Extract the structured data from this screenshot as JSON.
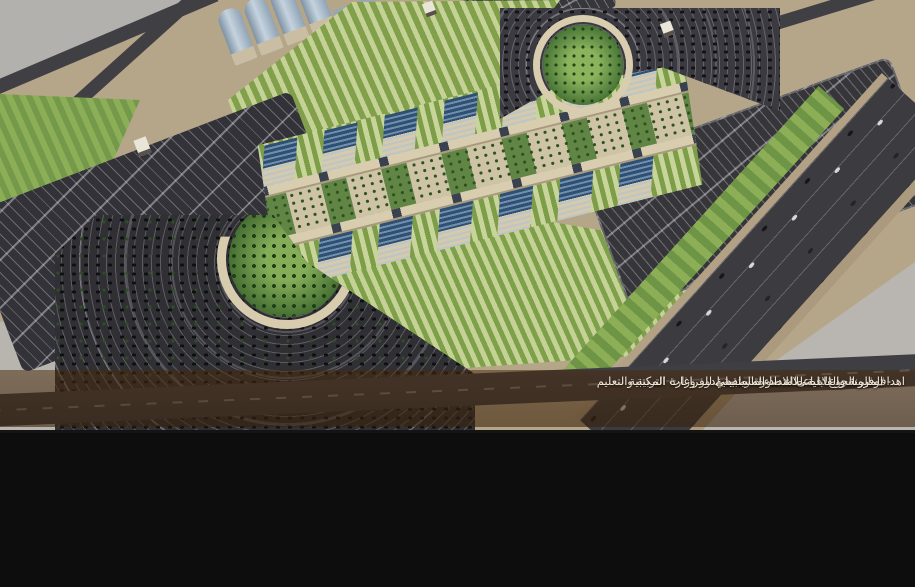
{
  "overlay": {
    "lines": [
      "اهداف المشروع :- اعطاء صورة ريادية لدور وزارة التربية والتعليم",
      "- توفير الحد الاقصى للاضاءة الطبيعية للفراغات المكتبية",
      "- المرونة والقابلية للامتداد المستقبلي"
    ]
  },
  "panels": {
    "plan_caption": "GROUND FLOOR PLAN"
  },
  "palette": {
    "sky_gray": "#b3b1ad",
    "desert_tan": "#b6a689",
    "asphalt": "#3b3b40",
    "parking_dark": "#2f2f34",
    "lawn_light": "#c8d59a",
    "lawn_dark": "#7e9d49",
    "building_beige": "#d8ccae",
    "roof_blue": "#2f4f73",
    "overlay_brown": "#4a2a0c",
    "overlay_text": "#f3ead8"
  }
}
